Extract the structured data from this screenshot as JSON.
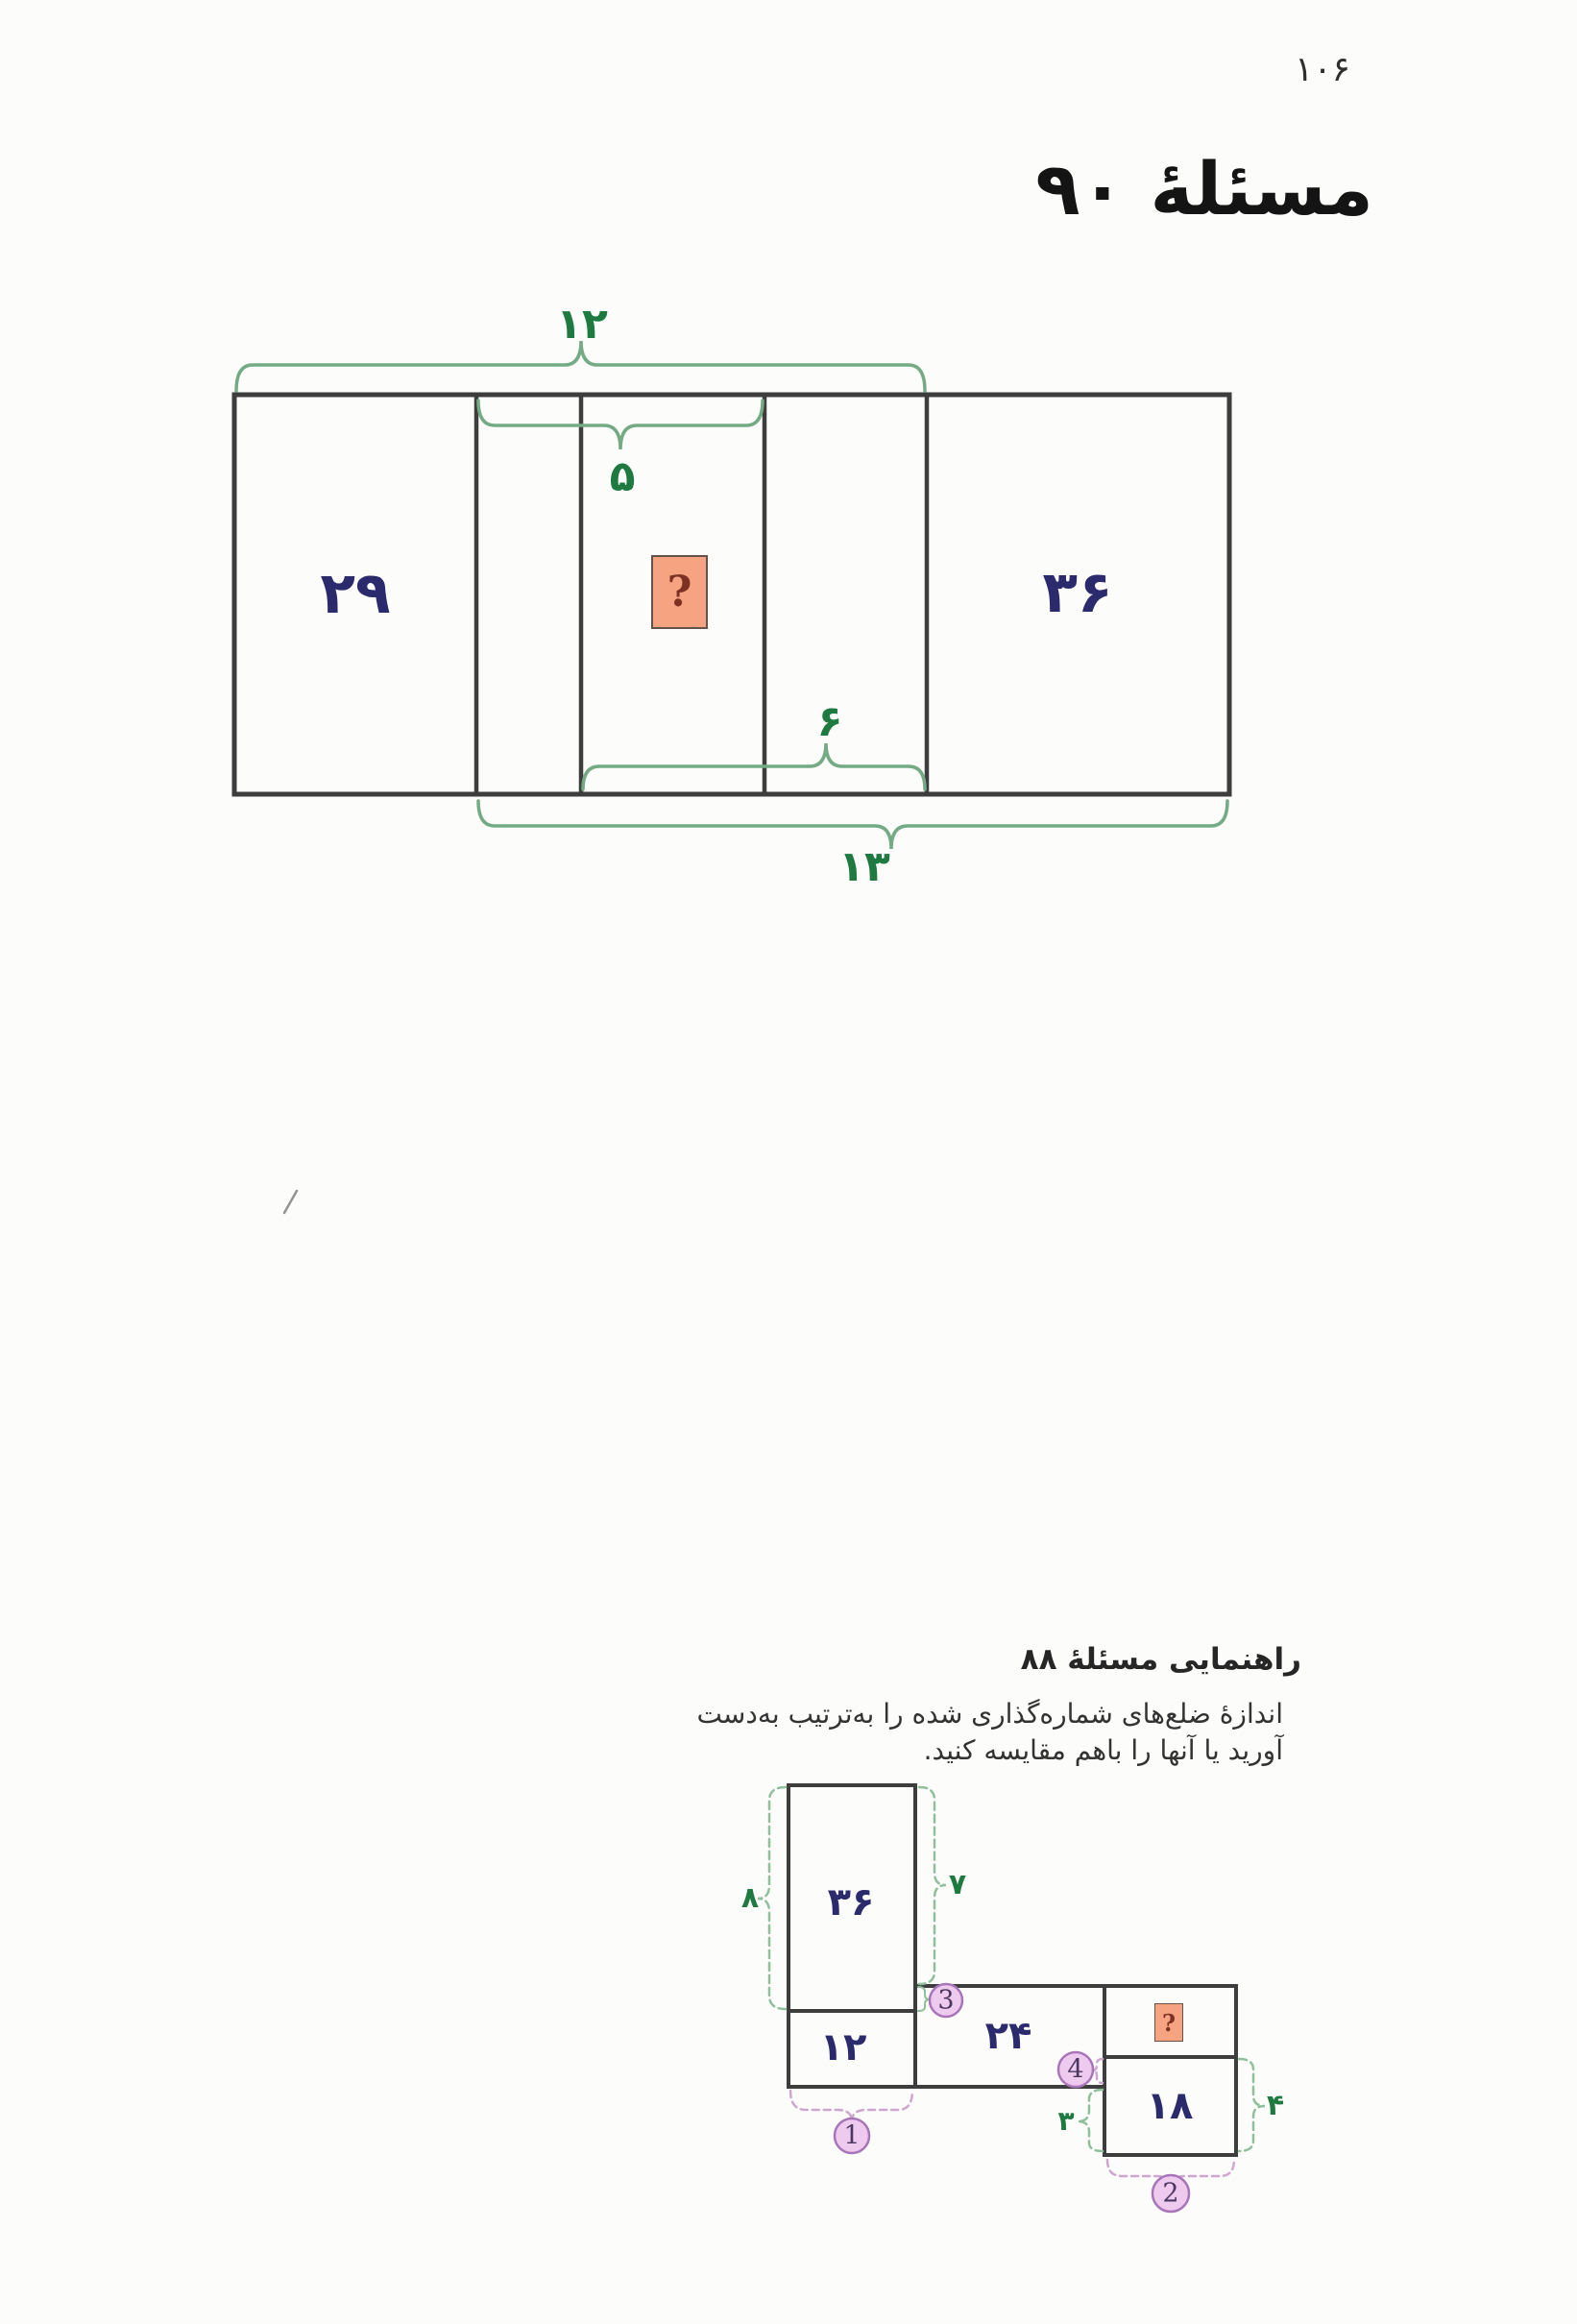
{
  "page": {
    "number": "۱۰۶"
  },
  "header": {
    "title": "مسئلهٔ ۹۰"
  },
  "main_figure": {
    "left_area": "۲۹",
    "right_area": "۳۶",
    "unknown_mark": "?",
    "top_width": "۱۲",
    "overlap_top_width": "۵",
    "overlap_bottom_width": "۶",
    "bottom_width": "۱۳"
  },
  "hint": {
    "heading": "راهنمایی مسئلهٔ ۸۸",
    "body_line1": "اندازهٔ ضلع‌های شماره‌گذاری شده را به‌ترتیب به‌دست",
    "body_line2": "آورید یا آنها را باهم مقایسه کنید.",
    "figure": {
      "tall_area": "۳۶",
      "small_area": "۱۲",
      "wide_area": "۲۴",
      "bottom_right_area": "۱۸",
      "unknown_mark": "?",
      "side_8": "۸",
      "side_7": "۷",
      "side_3": "۳",
      "side_4": "۴",
      "circle_1": "1",
      "circle_2": "2",
      "circle_3": "3",
      "circle_4": "4"
    }
  },
  "colors": {
    "navy_number": "#2b2a6d",
    "green_number": "#1e7a41",
    "green_brace": "#74ab84",
    "green_brace_dashed": "#8fbf9b",
    "pink_brace": "#cfa6d0",
    "orange_box_fill": "#f5a381",
    "question_mark": "#7c3122",
    "circle_fill": "#efcaef",
    "circle_border": "#a876b8",
    "line_black": "#3d3d3d"
  }
}
